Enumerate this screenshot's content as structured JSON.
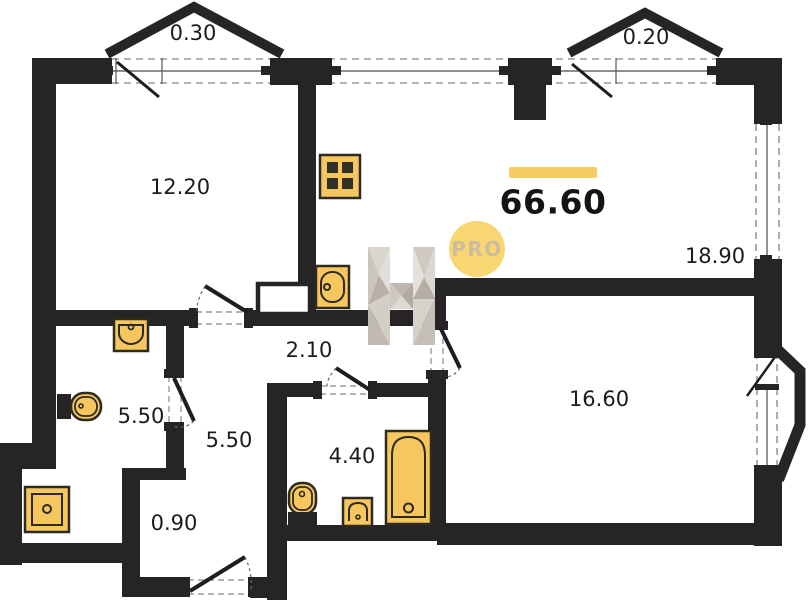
{
  "title": "apartment-floor-plan",
  "total": {
    "area": "66.60"
  },
  "badge": {
    "label": "PRO"
  },
  "rooms": {
    "balcony_left": {
      "area": "0.30"
    },
    "balcony_right": {
      "area": "0.20"
    },
    "room_top_left": {
      "area": "12.20"
    },
    "living_kitchen": {
      "area": "18.90"
    },
    "corridor": {
      "area": "2.10"
    },
    "bathroom_left": {
      "area": "5.50"
    },
    "hallway": {
      "area": "5.50"
    },
    "bathroom": {
      "area": "4.40"
    },
    "entry_nook": {
      "area": "0.90"
    },
    "bedroom": {
      "area": "16.60"
    }
  },
  "fixtures": [
    "stove-icon",
    "kitchen-sink-icon",
    "wall-sink-icon",
    "toilet-icon",
    "shower-tray-icon",
    "toilet-icon",
    "small-sink-icon",
    "bathtub-icon"
  ],
  "watermark": {
    "icon": "h-logo-icon"
  },
  "colors": {
    "wall": "#262424",
    "fixture_fill": "#F6C75E",
    "fixture_stroke": "#2d2a20",
    "accent_bar": "#F5CE63",
    "badge_fill": "#F8D772",
    "badge_text": "#CBBD9E",
    "dash_gray": "#9a9a9a"
  }
}
